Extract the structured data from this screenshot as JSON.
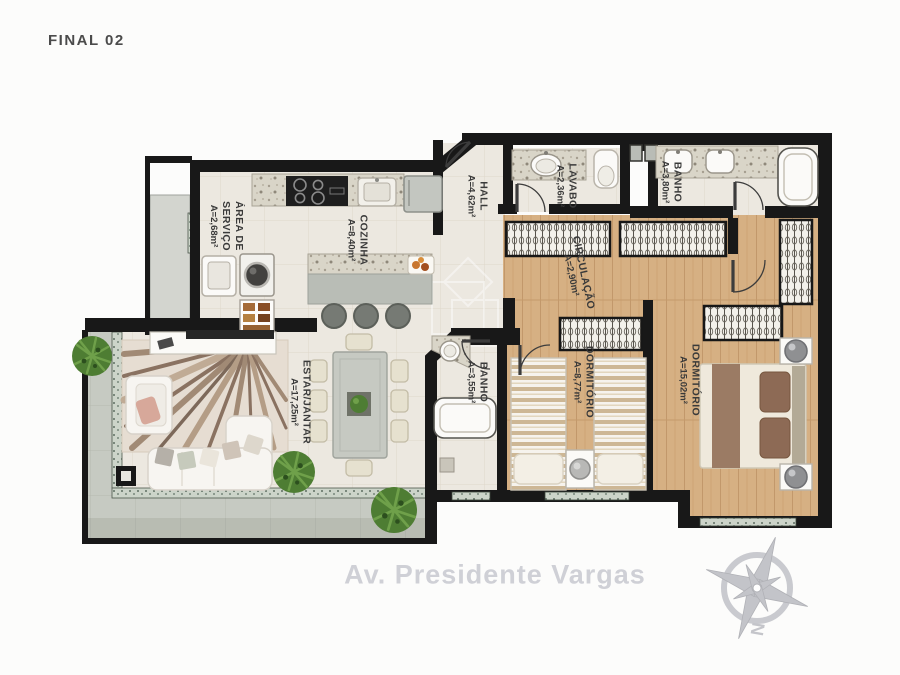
{
  "title": "FINAL 02",
  "street": "Av. Presidente Vargas",
  "compass": {
    "north_label": "N"
  },
  "rooms": {
    "servico": {
      "name": "ÁREA DE SERVIÇO",
      "area": "A=2,68m²"
    },
    "cozinha": {
      "name": "COZINHA",
      "area": "A=8,40m²"
    },
    "hall": {
      "name": "HALL",
      "area": "A=4,62m²"
    },
    "lavabo": {
      "name": "LAVABO",
      "area": "A=2,36m²"
    },
    "banho1": {
      "name": "BANHO",
      "area": "A=3,80m²"
    },
    "circulacao": {
      "name": "CIRCULAÇÃO",
      "area": "A=2,90m²"
    },
    "dorm1": {
      "name": "DORMITÓRIO",
      "area": "A=8,77m²"
    },
    "dorm2": {
      "name": "DORMITÓRIO",
      "area": "A=15,02m²"
    },
    "banho2": {
      "name": "BANHO",
      "area": "A=3,55m²"
    },
    "estar": {
      "name": "ESTAR/JANTAR",
      "area": "A=17,25m²"
    }
  },
  "colors": {
    "wall": "#181818",
    "tile_floor": "#ece8e0",
    "wood_floor": "#d6b083",
    "terrace": "#c6cac2",
    "glass": "#ccd4c9",
    "granite": "#d9d5c8",
    "label_text": "#3a3a3a",
    "street_text": "#cfd0d6",
    "plant_green": "#4e7d33"
  }
}
